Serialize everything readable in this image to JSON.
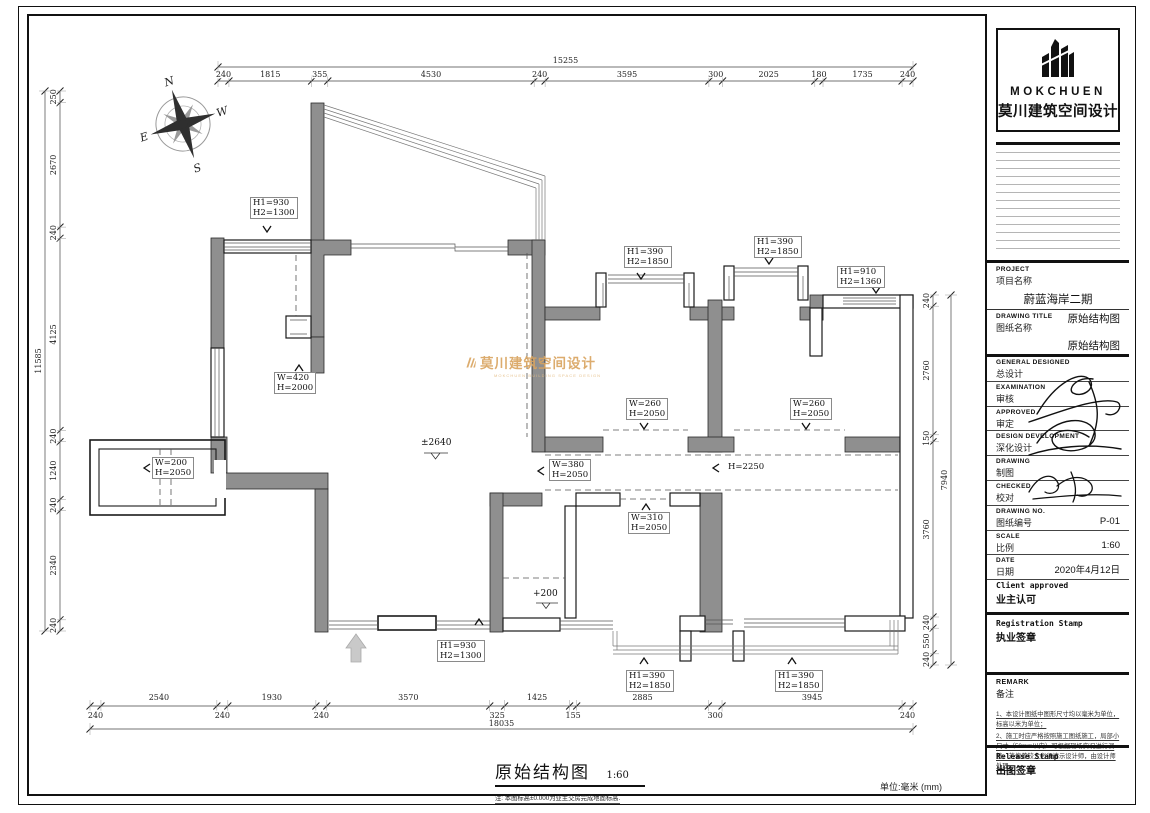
{
  "sheet": {
    "title": "原始结构图",
    "title_scale": "1:60",
    "title_note": "注: 本图标高±0.000为业主交房完成地面标高.",
    "unit_note": "单位:毫米 (mm)"
  },
  "compass": {
    "north": "N",
    "south": "S",
    "east": "E",
    "west": "W"
  },
  "watermark": {
    "name": "莫川建筑空间设计",
    "sub": "MOKCHUEN BUILDING SPACE DESIGN"
  },
  "levels": [
    {
      "id": "living-level",
      "text": "±2640"
    },
    {
      "id": "bath-level",
      "text": "+200"
    }
  ],
  "plan_labels": [
    {
      "id": "win-top-left",
      "lines": [
        "H1=930",
        "H2=1300"
      ]
    },
    {
      "id": "bay-window",
      "lines": [
        "W=420",
        "H=2000"
      ]
    },
    {
      "id": "door-west",
      "lines": [
        "W=200",
        "H=2050"
      ]
    },
    {
      "id": "win-bed1",
      "lines": [
        "H1=390",
        "H2=1850"
      ]
    },
    {
      "id": "win-bed2",
      "lines": [
        "H1=390",
        "H2=1850"
      ]
    },
    {
      "id": "win-ne",
      "lines": [
        "H1=910",
        "H2=1360"
      ]
    },
    {
      "id": "door-bed1",
      "lines": [
        "W=260",
        "H=2050"
      ]
    },
    {
      "id": "door-bed2",
      "lines": [
        "W=260",
        "H=2050"
      ]
    },
    {
      "id": "opening-corridor",
      "lines": [
        "W=380",
        "H=2050"
      ]
    },
    {
      "id": "opening-dining",
      "lines": [
        "H=2250"
      ]
    },
    {
      "id": "door-room",
      "lines": [
        "W=310",
        "H=2050"
      ]
    },
    {
      "id": "door-entry",
      "lines": [
        "H1=930",
        "H2=1300"
      ]
    },
    {
      "id": "win-terrace-1",
      "lines": [
        "H1=390",
        "H2=1850"
      ]
    },
    {
      "id": "win-terrace-2",
      "lines": [
        "H1=390",
        "H2=1850"
      ]
    }
  ],
  "dimensions": {
    "top": {
      "total": "15255",
      "segments": [
        "240",
        "1815",
        "355",
        "4530",
        "240",
        "3595",
        "300",
        "2025",
        "180",
        "1735",
        "240"
      ]
    },
    "left": {
      "total": "11585",
      "segments": [
        "250",
        "2670",
        "240",
        "4125",
        "240",
        "1240",
        "240",
        "2340",
        "240"
      ]
    },
    "right": {
      "total": "7940",
      "segments": [
        "240",
        "2760",
        "150",
        "3760",
        "240",
        "550",
        "240"
      ]
    },
    "bottom": {
      "total": "18035",
      "segments": [
        "240",
        "2540",
        "240",
        "1930",
        "240",
        "3570",
        "325",
        "1425",
        "155",
        "2885",
        "300",
        "3945",
        "240"
      ]
    }
  },
  "title_block": {
    "brand": "MOKCHUEN",
    "company": "莫川建筑空间设计",
    "project": {
      "en": "PROJECT",
      "zh": "项目名称",
      "value": "蔚蓝海岸二期",
      "value2": "原始结构图"
    },
    "drawing_title": {
      "en": "DRAWING TITLE",
      "zh": "图纸名称",
      "value": "原始结构图"
    },
    "rows": [
      {
        "en": "GENERAL  DESIGNED",
        "zh": "总设计",
        "value": ""
      },
      {
        "en": "EXAMINATION",
        "zh": "审核",
        "value": ""
      },
      {
        "en": "APPROVED",
        "zh": "审定",
        "value": ""
      },
      {
        "en": "DESIGN DEVELOPMENT",
        "zh": "深化设计",
        "value": ""
      },
      {
        "en": "DRAWING",
        "zh": "制图",
        "value": ""
      },
      {
        "en": "CHECKED",
        "zh": "校对",
        "value": ""
      },
      {
        "en": "DRAWING NO.",
        "zh": "图纸编号",
        "value": "P-01"
      },
      {
        "en": "SCALE",
        "zh": "比例",
        "value": "1:60"
      },
      {
        "en": "DATE",
        "zh": "日期",
        "value": "2020年4月12日"
      }
    ],
    "client": {
      "en": "Client approved",
      "zh": "业主认可"
    },
    "registration": {
      "en": "Registration Stamp",
      "zh": "执业签章"
    },
    "remark": {
      "en": "REMARK",
      "zh": "备注",
      "notes": [
        "1、本设计图纸中图形尺寸均以毫米为单位，标高以米为单位；",
        "2、施工时应严格按照施工图纸施工，局部小尺寸（50mm以内）可根据现场实况进行调整，若偏差较大必须请示设计师，由设计师处理。"
      ]
    },
    "release": {
      "en": "Release Stamp",
      "zh": "出图签章"
    }
  }
}
